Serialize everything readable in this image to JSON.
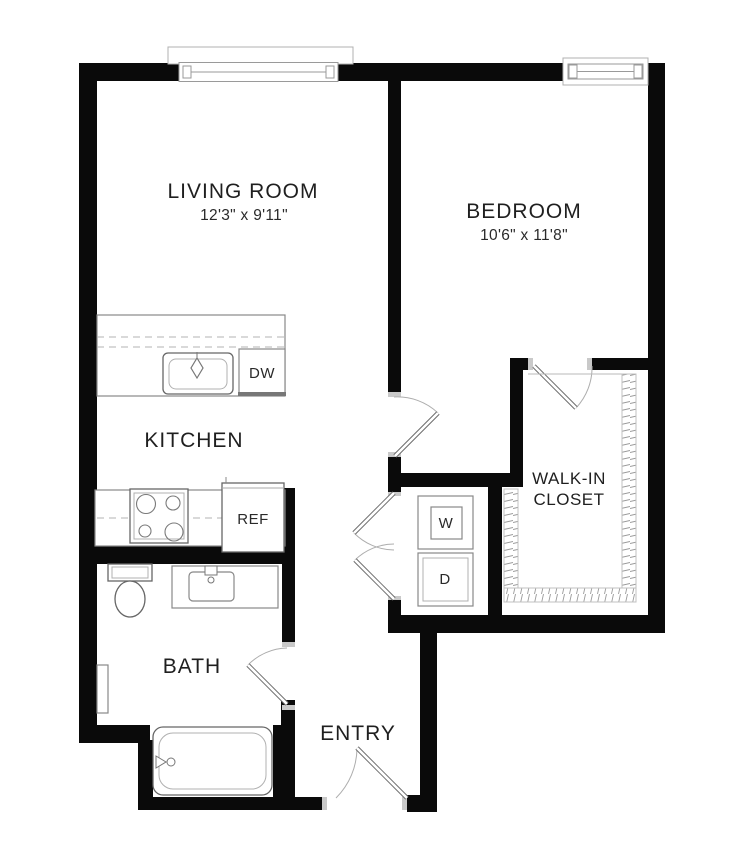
{
  "plan": {
    "title": "one-bedroom apartment floor plan",
    "rooms": {
      "living_room": {
        "name": "LIVING ROOM",
        "dimensions": "12'3\" x 9'11\""
      },
      "bedroom": {
        "name": "BEDROOM",
        "dimensions": "10'6\" x 11'8\""
      },
      "kitchen": {
        "name": "KITCHEN"
      },
      "bath": {
        "name": "BATH"
      },
      "walk_in_closet": {
        "name_line1": "WALK-IN",
        "name_line2": "CLOSET"
      },
      "entry": {
        "name": "ENTRY"
      }
    },
    "appliances": {
      "dishwasher": "DW",
      "refrigerator": "REF",
      "washer": "W",
      "dryer": "D"
    },
    "colors": {
      "wall": "#0a0a0a",
      "fixture_line": "#888888",
      "text": "#1f1f1f",
      "background": "#ffffff"
    }
  }
}
